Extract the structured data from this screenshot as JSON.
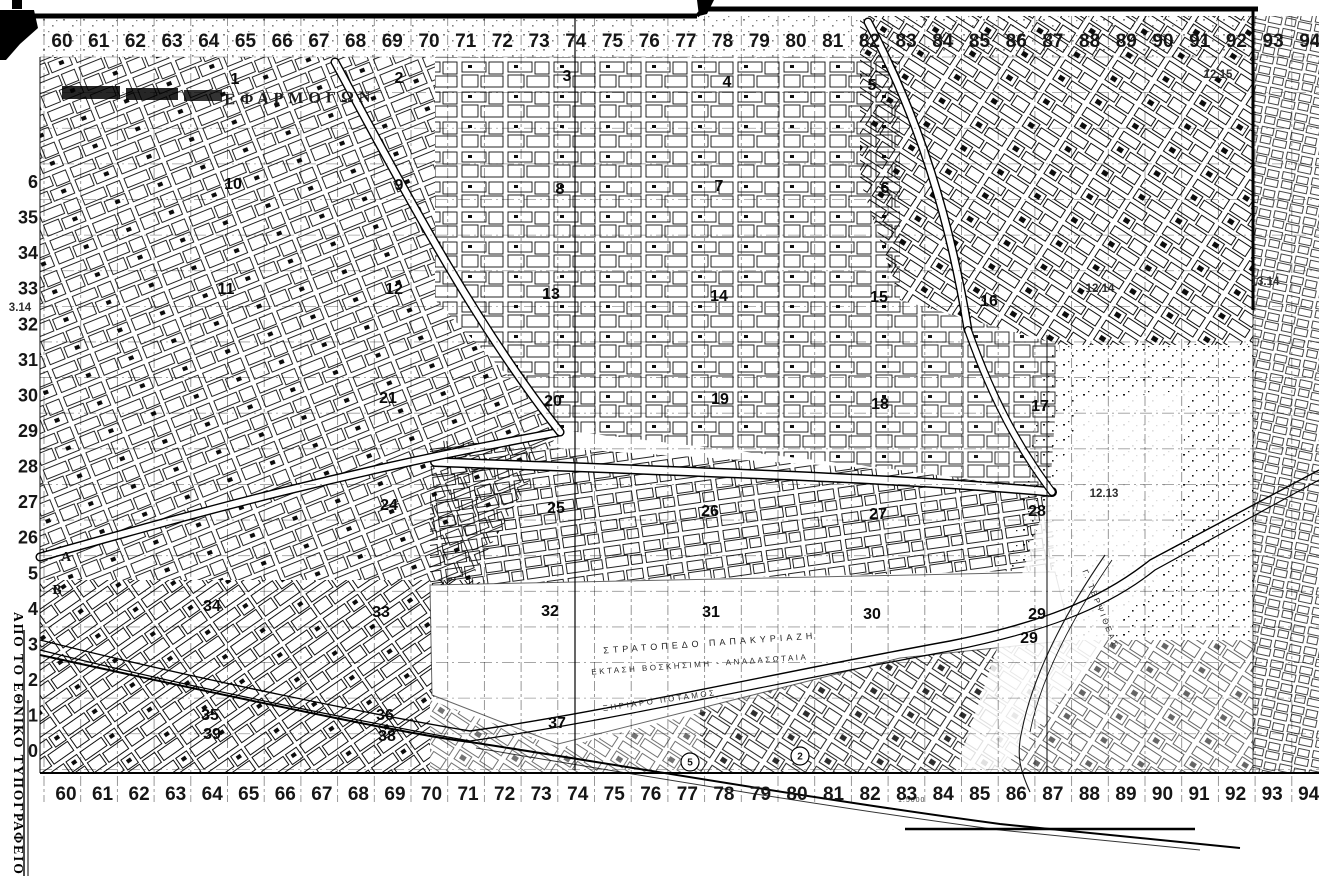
{
  "map": {
    "columns": [
      "60",
      "61",
      "62",
      "63",
      "64",
      "65",
      "66",
      "67",
      "68",
      "69",
      "70",
      "71",
      "72",
      "73",
      "74",
      "75",
      "76",
      "77",
      "78",
      "79",
      "80",
      "81",
      "82",
      "83",
      "84",
      "85",
      "86",
      "87",
      "88",
      "89",
      "90",
      "91",
      "92",
      "93",
      "94"
    ],
    "rows_left": [
      "6",
      "35",
      "34",
      "33",
      "32",
      "31",
      "30",
      "29",
      "28",
      "27",
      "26",
      "5",
      "4",
      "3",
      "2",
      "1",
      "0"
    ],
    "sectors": [
      {
        "label": "1",
        "x": 235,
        "y": 84
      },
      {
        "label": "2",
        "x": 399,
        "y": 83
      },
      {
        "label": "3",
        "x": 567,
        "y": 81
      },
      {
        "label": "4",
        "x": 727,
        "y": 87
      },
      {
        "label": "5",
        "x": 872,
        "y": 90
      },
      {
        "label": "10",
        "x": 233,
        "y": 189
      },
      {
        "label": "9",
        "x": 399,
        "y": 190
      },
      {
        "label": "8",
        "x": 560,
        "y": 194
      },
      {
        "label": "7",
        "x": 719,
        "y": 191
      },
      {
        "label": "6",
        "x": 885,
        "y": 193
      },
      {
        "label": "11",
        "x": 226,
        "y": 294
      },
      {
        "label": "12",
        "x": 394,
        "y": 294
      },
      {
        "label": "13",
        "x": 551,
        "y": 299
      },
      {
        "label": "14",
        "x": 719,
        "y": 301
      },
      {
        "label": "15",
        "x": 879,
        "y": 302
      },
      {
        "label": "16",
        "x": 989,
        "y": 306
      },
      {
        "label": "21",
        "x": 388,
        "y": 403
      },
      {
        "label": "20",
        "x": 553,
        "y": 406
      },
      {
        "label": "19",
        "x": 720,
        "y": 404
      },
      {
        "label": "18",
        "x": 880,
        "y": 409
      },
      {
        "label": "17",
        "x": 1040,
        "y": 411
      },
      {
        "label": "24",
        "x": 389,
        "y": 510
      },
      {
        "label": "25",
        "x": 556,
        "y": 513
      },
      {
        "label": "26",
        "x": 710,
        "y": 516
      },
      {
        "label": "27",
        "x": 878,
        "y": 519
      },
      {
        "label": "28",
        "x": 1037,
        "y": 516
      },
      {
        "label": "34",
        "x": 212,
        "y": 611
      },
      {
        "label": "33",
        "x": 381,
        "y": 617
      },
      {
        "label": "32",
        "x": 550,
        "y": 616
      },
      {
        "label": "31",
        "x": 711,
        "y": 617
      },
      {
        "label": "30",
        "x": 872,
        "y": 619
      },
      {
        "label": "29",
        "x": 1037,
        "y": 619
      },
      {
        "label": "29",
        "x": 1029,
        "y": 643
      },
      {
        "label": "35",
        "x": 210,
        "y": 720
      },
      {
        "label": "39",
        "x": 212,
        "y": 739
      },
      {
        "label": "36",
        "x": 385,
        "y": 720
      },
      {
        "label": "38",
        "x": 387,
        "y": 741
      },
      {
        "label": "37",
        "x": 557,
        "y": 728
      }
    ],
    "refs": [
      {
        "label": "12.15",
        "x": 1218,
        "y": 78
      },
      {
        "label": "13.14",
        "x": 1265,
        "y": 285
      },
      {
        "label": "12.14",
        "x": 1100,
        "y": 292
      },
      {
        "label": "12.13",
        "x": 1104,
        "y": 497
      },
      {
        "label": "3.14",
        "x": 20,
        "y": 311
      }
    ],
    "circled": [
      {
        "label": "5",
        "x": 690,
        "y": 762
      },
      {
        "label": "2",
        "x": 800,
        "y": 756
      }
    ],
    "texts": {
      "efarmogon": "ΕΦΑΡΜΟΓΩΝ",
      "camp_line1": "ΣΤΡΑΤΟΠΕΔΟ ΠΑΠΑΚΥΡΙΑΖΗ",
      "camp_line2": "ΕΚΤΑΣΗ ΒΟΣΚΗΣΙΜΗ - ΑΝΑΔΑΣΩΤΑΙΑ",
      "river": "ΞΗΡΙΑΡΟ ΠΟΤΑΜΟΣ",
      "stream": "Γ. ΤΕΡΨΙΘΕΑΣ",
      "margin": "ΑΠΟ ΤΟ ΕΘΝΙΚΟ ΤΥΠΟΓΡΑΦΕΙΟ",
      "scale": "1:5000",
      "letter_a": "Α",
      "letter_b": "Β"
    },
    "colors": {
      "paper": "#ffffff",
      "ink": "#111111"
    }
  }
}
